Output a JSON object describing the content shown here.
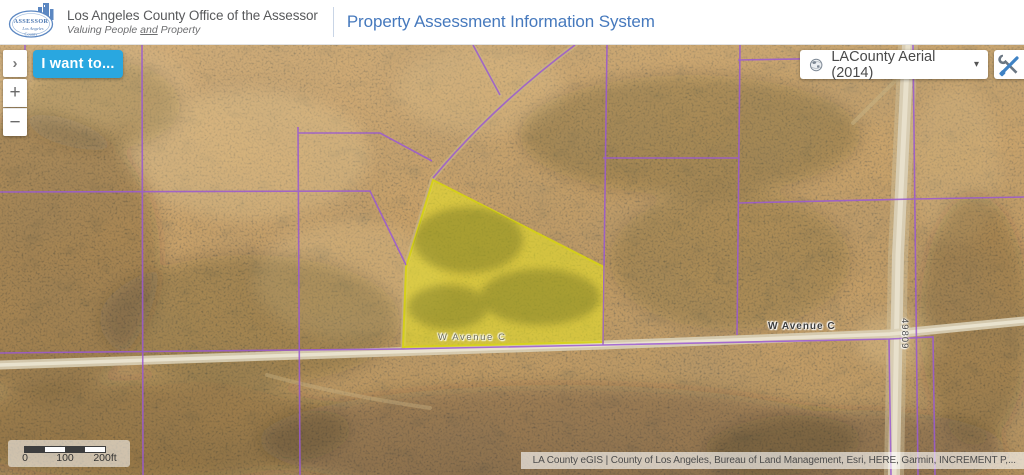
{
  "header": {
    "seal": {
      "main": "ASSESSOR",
      "sub1": "Los Angeles",
      "sub2": "County"
    },
    "org_name": "Los Angeles County Office of the Assessor",
    "tagline": {
      "pre": "Valuing People ",
      "and": "and",
      "post": " Property"
    },
    "app_title": "Property Assessment Information System"
  },
  "controls": {
    "expand": "›",
    "i_want_to": "I want to...",
    "zoom_in": "+",
    "zoom_out": "−"
  },
  "basemap_selector": {
    "label": "LACounty Aerial (2014)",
    "caret": "▾"
  },
  "map": {
    "road_labels": [
      "W Avenue C",
      "W Avenue C"
    ],
    "street_number_label": "49809",
    "scale_bar": {
      "tick0": "0",
      "tick1": "100",
      "tick2": "200ft"
    },
    "attribution": "LA County eGIS | County of Los Angeles, Bureau of Land Management, Esri, HERE, Garmin, INCREMENT P,..."
  },
  "colors": {
    "accent_blue": "#29A7E0",
    "title_blue": "#4679BD",
    "parcel_highlight": "#E8E523",
    "parcel_line_purple": "#9A5AD1"
  }
}
